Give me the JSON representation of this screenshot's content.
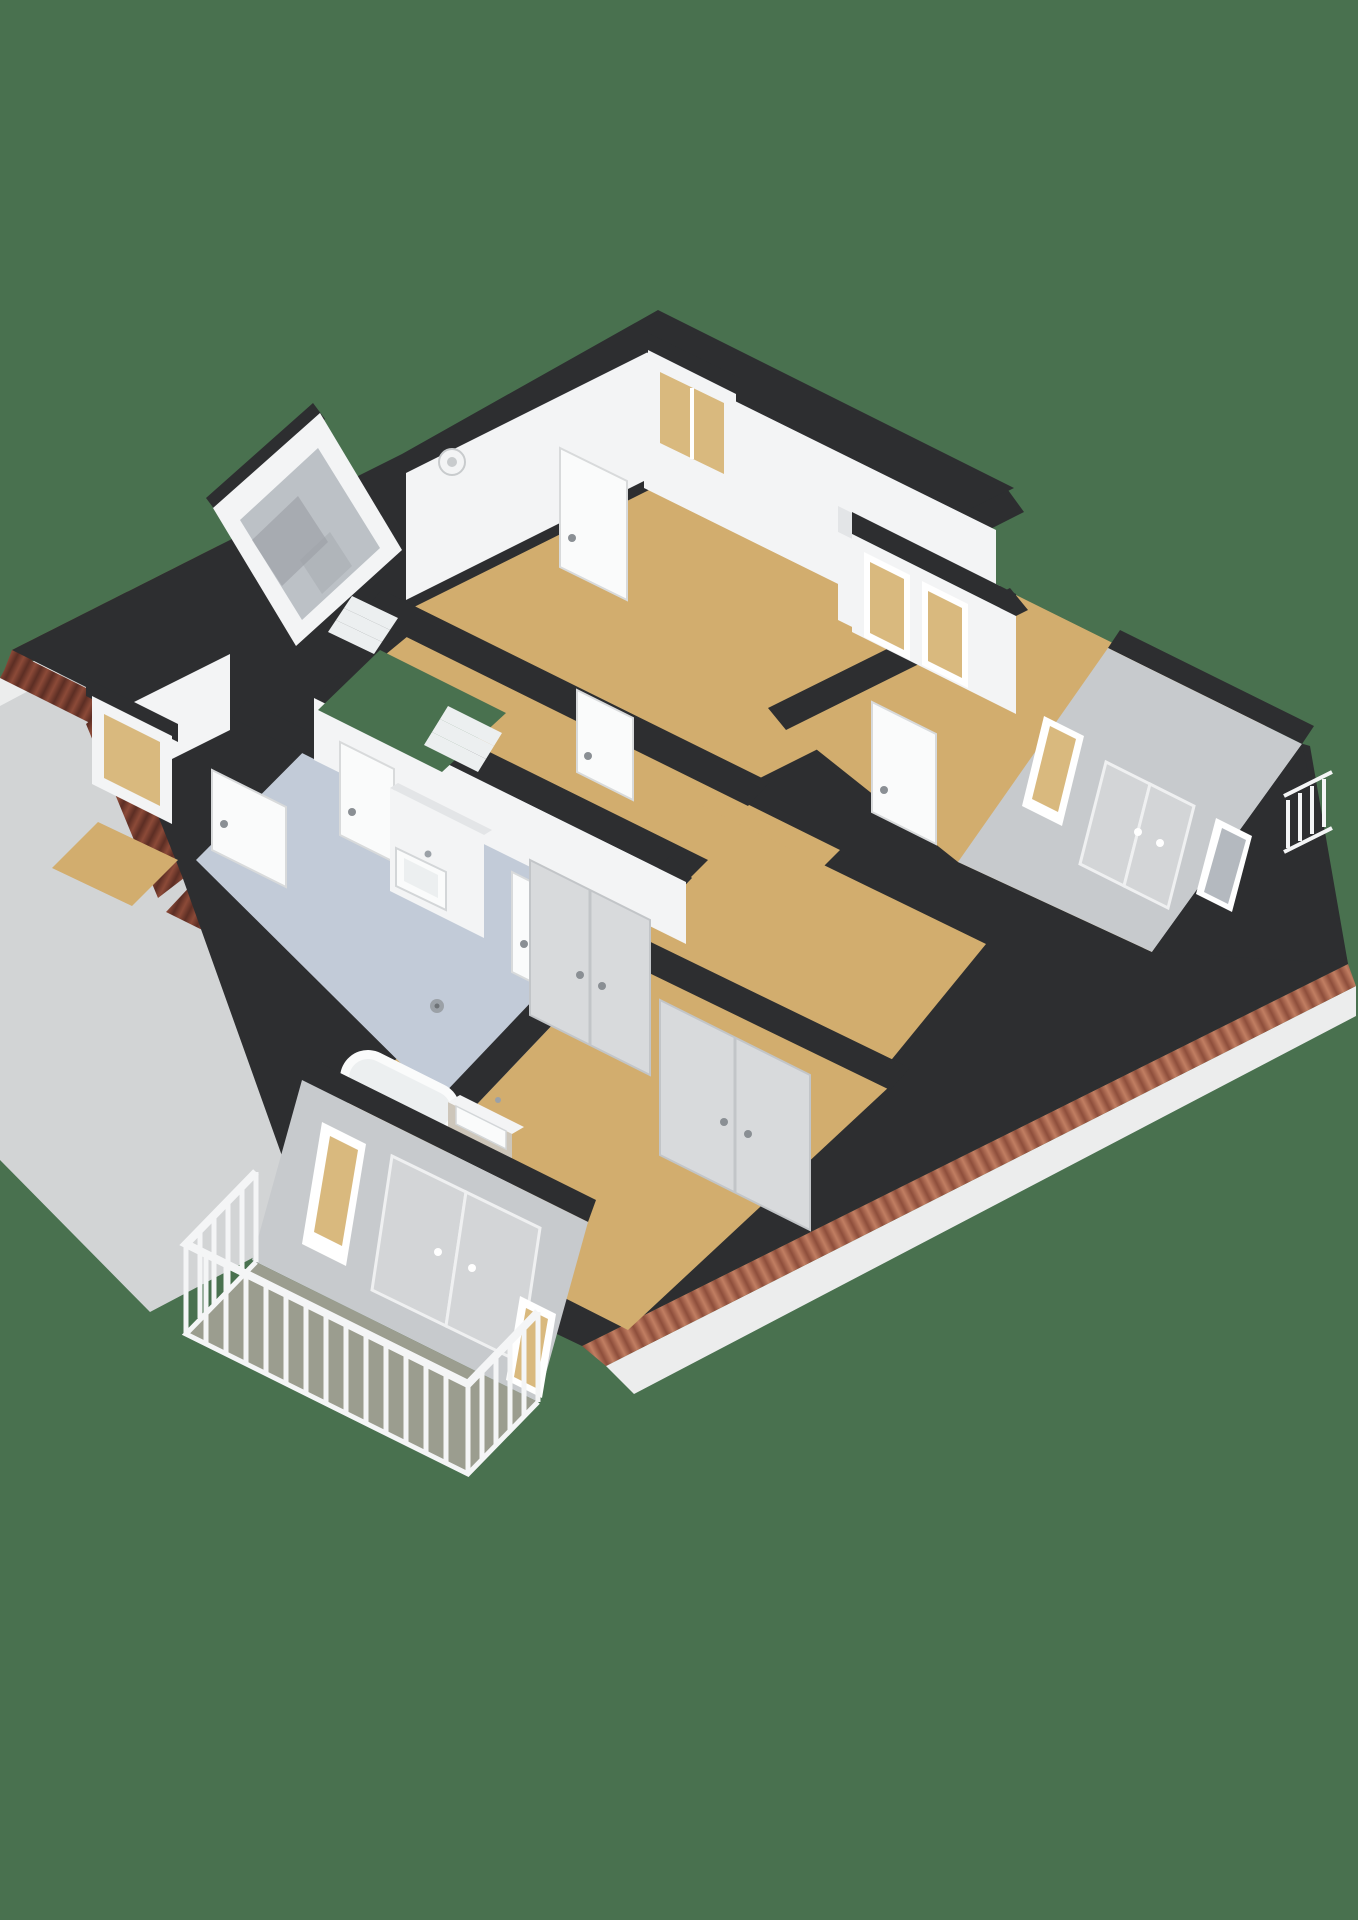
{
  "scene": {
    "description": "3D isometric cutaway floor plan render of an upper storey shown from above on a solid green background",
    "visible_text": "none",
    "render_style": "photoreal 3D floorplan"
  },
  "palette": {
    "background": "#49714F",
    "wall_top": "#2D2E30",
    "wall_white": "#F3F4F5",
    "wall_white_shaded": "#E3E5E7",
    "wall_gray": "#C7CACD",
    "closet_gray": "#D8DADC",
    "door_white": "#FAFBFB",
    "door_frame": "#D8DADB",
    "floor_wood": "#D2AD6E",
    "floor_bath": "#C2CBD8",
    "floor_balcony": "#9B9D8F",
    "roof_slope": "#D2D4D5",
    "fascia": "#ECEDED",
    "tile_se_light": "#C17E62",
    "tile_se_dark": "#8E4E3B",
    "tile_w_light": "#8C4A38",
    "tile_w_dark": "#5C2E24",
    "glass_tan": "#D9B97E",
    "glass_gray": "#B4B9BF",
    "railing_white": "#F4F5F6",
    "metal": "#9BA1A7",
    "step_white": "#ECEFF0",
    "handle_gray": "#8A8F94"
  },
  "rooms": [
    {
      "name": "bedroom-top",
      "floor": "wood"
    },
    {
      "name": "bedroom-right",
      "floor": "wood"
    },
    {
      "name": "bedroom-bottom-left",
      "floor": "wood"
    },
    {
      "name": "bathroom",
      "floor": "light-blue"
    },
    {
      "name": "hallway-with-stairwell",
      "floor": "wood"
    },
    {
      "name": "toilet",
      "floor": "wood"
    },
    {
      "name": "walk-in-closet",
      "floor": "wood"
    },
    {
      "name": "balcony",
      "floor": "gray-green"
    }
  ],
  "fixtures": [
    "wall-sink",
    "bathtub",
    "shower-drain",
    "vanity-basin",
    "wardrobe-closets",
    "staircase",
    "interior-doors",
    "dormer-windows",
    "skylight-window",
    "balcony-railing"
  ]
}
